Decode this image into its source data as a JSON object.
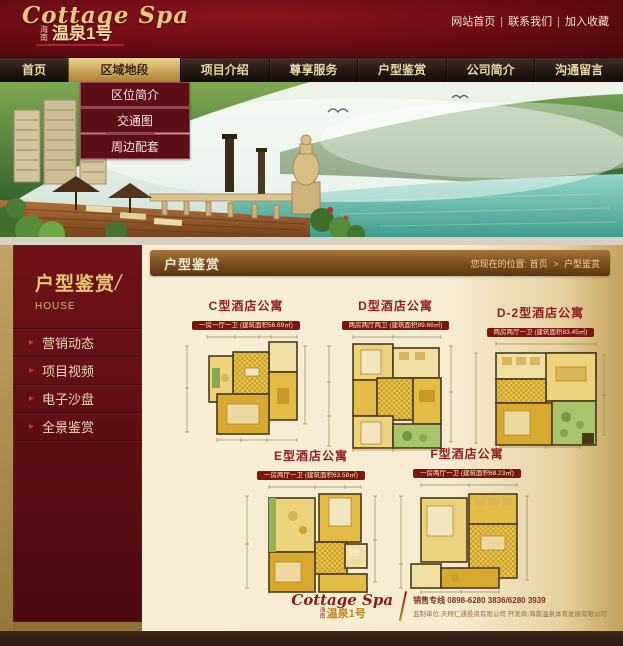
{
  "topbar": {
    "links": [
      {
        "label": "网站首页"
      },
      {
        "label": "联系我们"
      },
      {
        "label": "加入收藏"
      }
    ],
    "separator": "|"
  },
  "logo": {
    "script": "Cottage Spa",
    "prefix": "海南",
    "name": "温泉1号"
  },
  "nav": {
    "items": [
      {
        "label": "首页"
      },
      {
        "label": "区域地段"
      },
      {
        "label": "项目介绍"
      },
      {
        "label": "尊享服务"
      },
      {
        "label": "户型鉴赏"
      },
      {
        "label": "公司简介"
      },
      {
        "label": "沟通留言"
      }
    ]
  },
  "dropdown": {
    "items": [
      {
        "label": "区位简介"
      },
      {
        "label": "交通图"
      },
      {
        "label": "周边配套"
      }
    ]
  },
  "sidebar": {
    "title": "户型鉴赏",
    "slash": "/",
    "subtitle": "HOUSE",
    "items": [
      {
        "label": "营销动态"
      },
      {
        "label": "项目视频"
      },
      {
        "label": "电子沙盘"
      },
      {
        "label": "全景鉴赏"
      }
    ],
    "arrow": "▸"
  },
  "content": {
    "title": "户型鉴赏",
    "breadcrumb": {
      "prefix": "您现在的位置:",
      "home": "首页",
      "separator": ">",
      "current": "户型鉴赏"
    }
  },
  "plans": [
    {
      "title": "C型酒店公寓",
      "subtitle": "一房一厅一卫 (建筑面积56.69㎡)"
    },
    {
      "title": "D型酒店公寓",
      "subtitle": "两房两厅两卫 (建筑面积89.66㎡)"
    },
    {
      "title": "D-2型酒店公寓",
      "subtitle": "两房两厅一卫 (建筑面积83.45㎡)"
    },
    {
      "title": "E型酒店公寓",
      "subtitle": "一房两厅一卫 (建筑面积63.58㎡)"
    },
    {
      "title": "F型酒店公寓",
      "subtitle": "一房两厅一卫 (建筑面积68.23㎡)"
    }
  ],
  "footer": {
    "logo_script": "Cottage Spa",
    "logo_prefix": "海南",
    "logo_name": "温泉1号",
    "phone_line": "销售专线 0898-6280 3836/6280 3939",
    "credit_line": "监制单位:天翔仁通投资有限公司  开发商:海南温泉体育发展有限公司"
  }
}
